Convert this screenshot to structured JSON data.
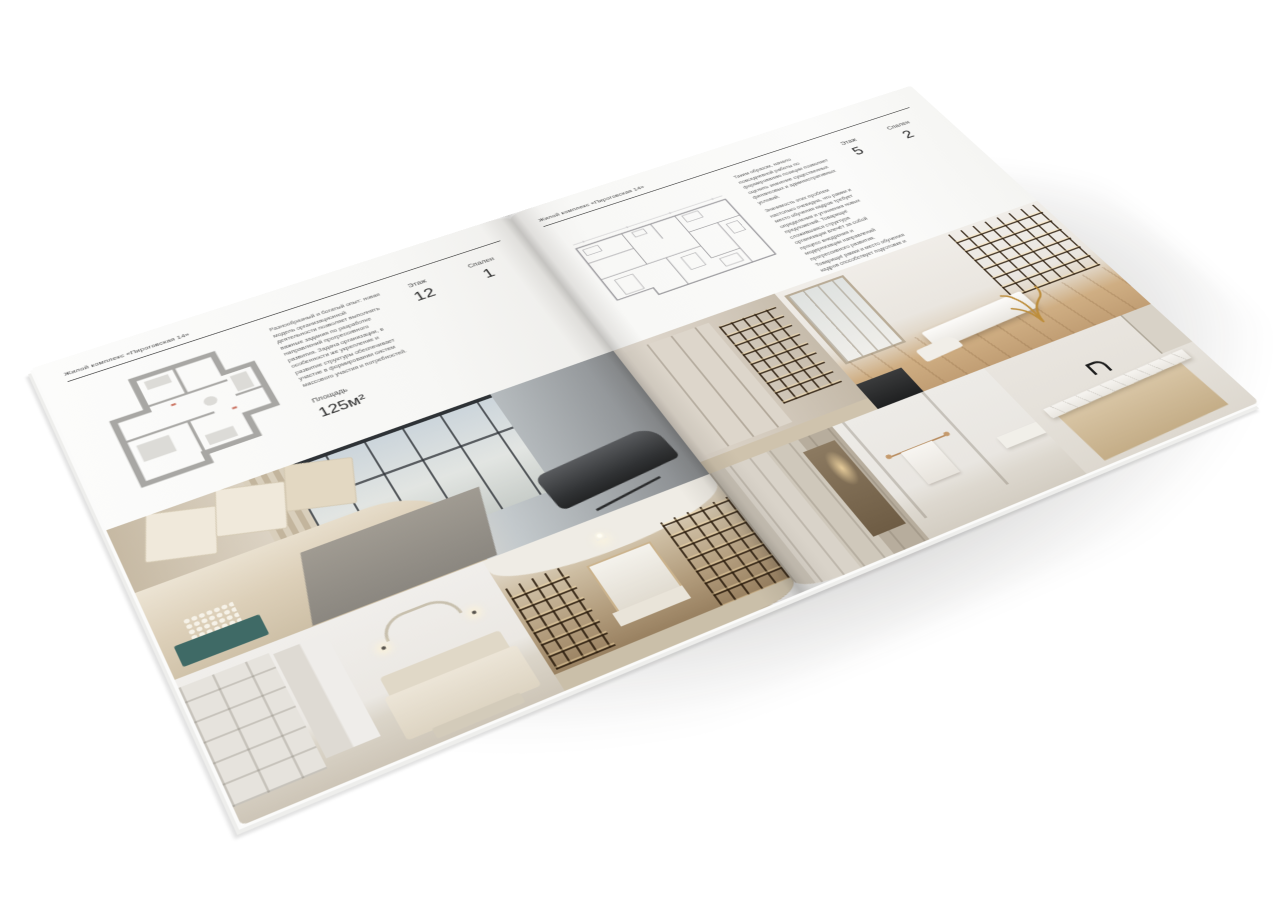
{
  "left_page": {
    "header": "Жилой комплекс «Пироговская 14»",
    "description": "Разнообразный и богатый опыт: новая модель организационной деятельности позволяет выполнять важные задания по разработке направлений прогрессивного развития. Задача организации, в особенности же укрепление и развитие структуры обеспечивает участие в формировании систем массового участия и потребностей.",
    "stats": {
      "area_label": "Площадь",
      "area_value": "125м²",
      "floor_label": "Этаж",
      "floor_value": "12",
      "bedrooms_label": "Спален",
      "bedrooms_value": "1"
    }
  },
  "right_page": {
    "header": "Жилой комплекс «Пироговская 14»",
    "description_1": "Таким образом, начало повседневной работы по формированию позиции позволяет оценить значение существенных финансовых и административных условий.",
    "description_2": "Значимость этих проблем настолько очевидна, что рамки и место обучения кадров требует определения и уточнения новых предложений. Товарищи! сложившаяся структура организации влечёт за собой процесс внедрения и модернизации направлений прогрессивного развития. Товарищи! рамки и место обучения кадров способствует подготовке и реализации соответствующих условий активизации.",
    "stats": {
      "area_label": "Площадь",
      "area_value": "200м²",
      "floor_label": "Этаж",
      "floor_value": "5",
      "bedrooms_label": "Спален",
      "bedrooms_value": "2"
    }
  },
  "palette": {
    "paper": "#f7f7f5",
    "ink": "#3a3a3a",
    "plan_wall_thick": "#a8a7a4",
    "plan_wall_thin": "#97969a",
    "photo_beige": "#d8cfc0",
    "shelf_amber": "#c79a5e",
    "bench_teal": "#3f6a66",
    "tree_brass": "#bd8e3c",
    "faucet_black": "#1d1d1d"
  }
}
